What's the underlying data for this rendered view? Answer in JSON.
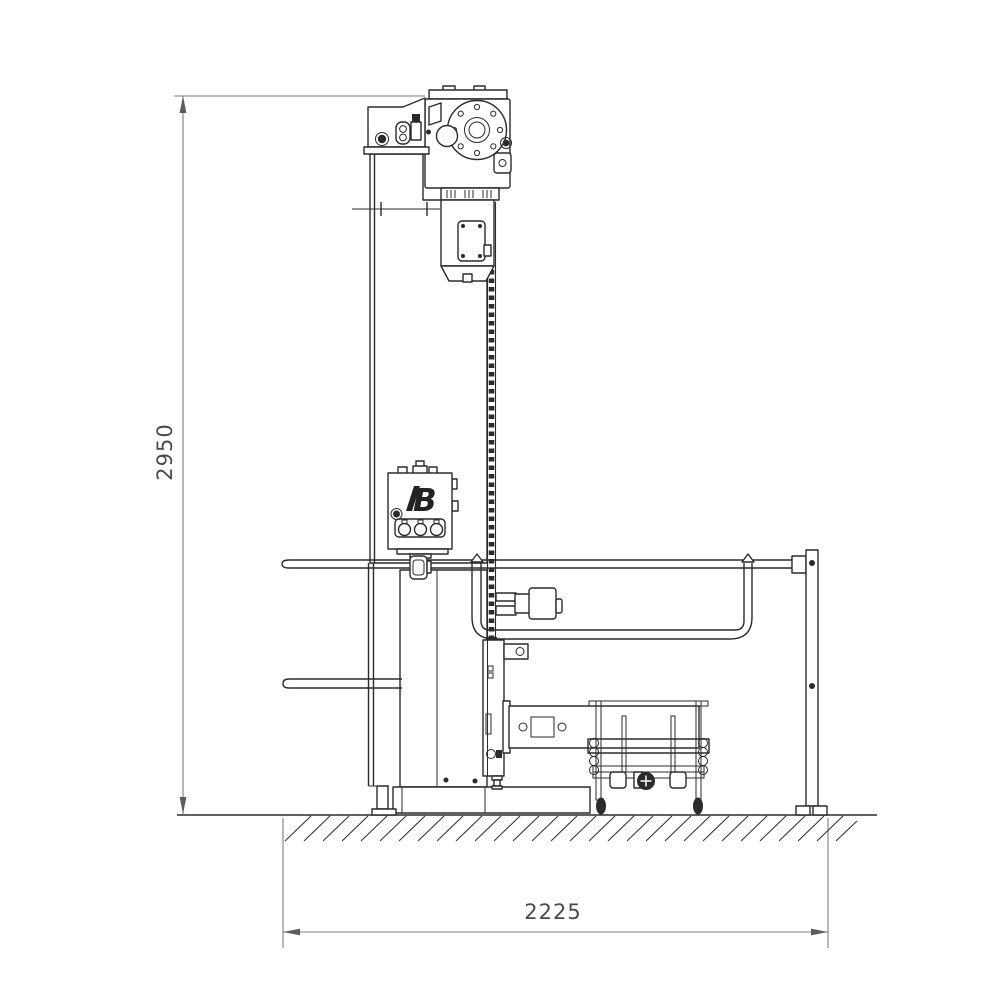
{
  "drawing": {
    "kind": "technical-side-elevation",
    "dimensions": {
      "height": {
        "value": "2950"
      },
      "width": {
        "value": "2225"
      }
    },
    "logo": {
      "text": "B"
    },
    "colors": {
      "line": "#2b2b2b",
      "dimension_line": "#7d7d7d",
      "dimension_text": "#4a4a4a",
      "background": "#ffffff"
    }
  }
}
